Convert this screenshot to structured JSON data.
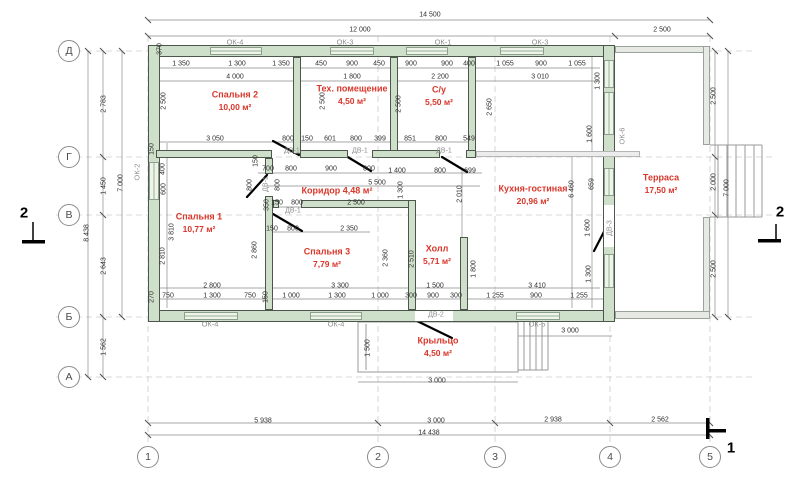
{
  "drawing": {
    "type": "floor-plan",
    "colors": {
      "wall": "#cfe0ca",
      "accent_red": "#d8372b",
      "gray_label": "#8e8e8e",
      "dim_text": "#2e2e2e"
    },
    "rooms": [
      {
        "name": "Спальня 2",
        "area": "10,00 м²",
        "x": 235,
        "y": 95
      },
      {
        "name": "Тех. помещение",
        "area": "4,50 м²",
        "x": 352,
        "y": 89
      },
      {
        "name": "С/у",
        "area": "5,50 м²",
        "x": 439,
        "y": 90
      },
      {
        "name": "Кухня-гостиная",
        "area": "20,96 м²",
        "x": 533,
        "y": 189
      },
      {
        "name": "Терраса",
        "area": "17,50 м²",
        "x": 661,
        "y": 178
      },
      {
        "name": "Коридор 4,48 м²",
        "area": "",
        "x": 337,
        "y": 191
      },
      {
        "name": "Спальня 1",
        "area": "10,77 м²",
        "x": 199,
        "y": 217
      },
      {
        "name": "Спальня 3",
        "area": "7,79 м²",
        "x": 327,
        "y": 252
      },
      {
        "name": "Холл",
        "area": "5,71 м²",
        "x": 437,
        "y": 249
      },
      {
        "name": "Крыльцо",
        "area": "4,50 м²",
        "x": 438,
        "y": 341
      }
    ],
    "window_labels": [
      {
        "t": "ОК-4",
        "x": 235,
        "y": 42
      },
      {
        "t": "ОК-3",
        "x": 345,
        "y": 42
      },
      {
        "t": "ОК-1",
        "x": 443,
        "y": 42
      },
      {
        "t": "ОК-3",
        "x": 540,
        "y": 42
      },
      {
        "t": "ОК-2",
        "x": 137,
        "y": 172,
        "r": 1
      },
      {
        "t": "ОК-6",
        "x": 622,
        "y": 136,
        "r": 1
      },
      {
        "t": "ОК-4",
        "x": 210,
        "y": 324
      },
      {
        "t": "ОК-4",
        "x": 336,
        "y": 324
      },
      {
        "t": "ОК-5",
        "x": 537,
        "y": 324
      }
    ],
    "door_labels": [
      {
        "t": "ДВ-1",
        "x": 292,
        "y": 151
      },
      {
        "t": "ДВ-1",
        "x": 360,
        "y": 151
      },
      {
        "t": "ДВ-1",
        "x": 444,
        "y": 151
      },
      {
        "t": "ДВ-1",
        "x": 266,
        "y": 184,
        "r": 1
      },
      {
        "t": "ДВ-1",
        "x": 293,
        "y": 211
      },
      {
        "t": "ДВ-2",
        "x": 436,
        "y": 315
      },
      {
        "t": "ДВ-3",
        "x": 610,
        "y": 228,
        "r": 1
      }
    ],
    "dims": [
      {
        "t": "14 500",
        "x": 430,
        "y": 15
      },
      {
        "t": "12 000",
        "x": 360,
        "y": 30
      },
      {
        "t": "2 500",
        "x": 662,
        "y": 30
      },
      {
        "t": "1 350",
        "x": 181,
        "y": 64
      },
      {
        "t": "1 300",
        "x": 237,
        "y": 64
      },
      {
        "t": "1 350",
        "x": 281,
        "y": 64
      },
      {
        "t": "450",
        "x": 321,
        "y": 64
      },
      {
        "t": "900",
        "x": 352,
        "y": 64
      },
      {
        "t": "450",
        "x": 379,
        "y": 64
      },
      {
        "t": "900",
        "x": 411,
        "y": 64
      },
      {
        "t": "900",
        "x": 447,
        "y": 64
      },
      {
        "t": "400",
        "x": 469,
        "y": 64
      },
      {
        "t": "1 055",
        "x": 505,
        "y": 64
      },
      {
        "t": "900",
        "x": 541,
        "y": 64
      },
      {
        "t": "1 055",
        "x": 577,
        "y": 64
      },
      {
        "t": "4 000",
        "x": 235,
        "y": 77
      },
      {
        "t": "1 800",
        "x": 352,
        "y": 77
      },
      {
        "t": "2 200",
        "x": 440,
        "y": 77
      },
      {
        "t": "3 010",
        "x": 540,
        "y": 77
      },
      {
        "t": "370",
        "x": 160,
        "y": 49,
        "r": 1
      },
      {
        "t": "2 500",
        "x": 164,
        "y": 101,
        "r": 1
      },
      {
        "t": "2 500",
        "x": 323,
        "y": 101,
        "r": 1
      },
      {
        "t": "2 500",
        "x": 399,
        "y": 104,
        "r": 1
      },
      {
        "t": "2 650",
        "x": 490,
        "y": 107,
        "r": 1
      },
      {
        "t": "1 300",
        "x": 598,
        "y": 81,
        "r": 1
      },
      {
        "t": "3 050",
        "x": 215,
        "y": 139
      },
      {
        "t": "800",
        "x": 288,
        "y": 139
      },
      {
        "t": "150",
        "x": 307,
        "y": 139
      },
      {
        "t": "601",
        "x": 330,
        "y": 139
      },
      {
        "t": "800",
        "x": 356,
        "y": 139
      },
      {
        "t": "399",
        "x": 380,
        "y": 139
      },
      {
        "t": "851",
        "x": 410,
        "y": 139
      },
      {
        "t": "800",
        "x": 441,
        "y": 139
      },
      {
        "t": "549",
        "x": 469,
        "y": 139
      },
      {
        "t": "700",
        "x": 268,
        "y": 169
      },
      {
        "t": "800",
        "x": 291,
        "y": 169
      },
      {
        "t": "900",
        "x": 331,
        "y": 169
      },
      {
        "t": "800",
        "x": 369,
        "y": 169
      },
      {
        "t": "1 400",
        "x": 397,
        "y": 171
      },
      {
        "t": "800",
        "x": 440,
        "y": 171
      },
      {
        "t": "699",
        "x": 470,
        "y": 171
      },
      {
        "t": "5 500",
        "x": 377,
        "y": 183
      },
      {
        "t": "1 300",
        "x": 401,
        "y": 190,
        "r": 1
      },
      {
        "t": "2 010",
        "x": 460,
        "y": 194,
        "r": 1
      },
      {
        "t": "150",
        "x": 256,
        "y": 161,
        "r": 1
      },
      {
        "t": "800",
        "x": 250,
        "y": 185,
        "r": 1
      },
      {
        "t": "800",
        "x": 278,
        "y": 185,
        "r": 1
      },
      {
        "t": "350",
        "x": 267,
        "y": 205,
        "r": 1
      },
      {
        "t": "150",
        "x": 277,
        "y": 203
      },
      {
        "t": "800",
        "x": 297,
        "y": 203
      },
      {
        "t": "2 500",
        "x": 356,
        "y": 203
      },
      {
        "t": "150",
        "x": 272,
        "y": 229
      },
      {
        "t": "800",
        "x": 293,
        "y": 229
      },
      {
        "t": "2 350",
        "x": 349,
        "y": 229
      },
      {
        "t": "150",
        "x": 152,
        "y": 149,
        "r": 1
      },
      {
        "t": "400",
        "x": 163,
        "y": 169,
        "r": 1
      },
      {
        "t": "600",
        "x": 164,
        "y": 189,
        "r": 1
      },
      {
        "t": "3 810",
        "x": 172,
        "y": 232,
        "r": 1
      },
      {
        "t": "2 810",
        "x": 163,
        "y": 256,
        "r": 1
      },
      {
        "t": "2 860",
        "x": 255,
        "y": 250,
        "r": 1
      },
      {
        "t": "2 360",
        "x": 386,
        "y": 258,
        "r": 1
      },
      {
        "t": "2 510",
        "x": 412,
        "y": 259,
        "r": 1
      },
      {
        "t": "1 800",
        "x": 474,
        "y": 269,
        "r": 1
      },
      {
        "t": "6 460",
        "x": 572,
        "y": 189,
        "r": 1
      },
      {
        "t": "1 600",
        "x": 590,
        "y": 134,
        "r": 1
      },
      {
        "t": "659",
        "x": 592,
        "y": 184,
        "r": 1
      },
      {
        "t": "1 600",
        "x": 588,
        "y": 228,
        "r": 1
      },
      {
        "t": "1 300",
        "x": 589,
        "y": 274,
        "r": 1
      },
      {
        "t": "2 783",
        "x": 104,
        "y": 104,
        "r": 1
      },
      {
        "t": "1 450",
        "x": 104,
        "y": 186,
        "r": 1
      },
      {
        "t": "7 000",
        "x": 121,
        "y": 183,
        "r": 1
      },
      {
        "t": "8 438",
        "x": 87,
        "y": 233,
        "r": 1
      },
      {
        "t": "2 643",
        "x": 104,
        "y": 266,
        "r": 1
      },
      {
        "t": "1 562",
        "x": 104,
        "y": 347,
        "r": 1
      },
      {
        "t": "2 500",
        "x": 714,
        "y": 96,
        "r": 1
      },
      {
        "t": "2 000",
        "x": 714,
        "y": 182,
        "r": 1
      },
      {
        "t": "2 500",
        "x": 714,
        "y": 269,
        "r": 1
      },
      {
        "t": "7 000",
        "x": 727,
        "y": 188,
        "r": 1
      },
      {
        "t": "2 800",
        "x": 212,
        "y": 286
      },
      {
        "t": "3 300",
        "x": 340,
        "y": 286
      },
      {
        "t": "1 500",
        "x": 435,
        "y": 286
      },
      {
        "t": "3 410",
        "x": 537,
        "y": 286
      },
      {
        "t": "270",
        "x": 152,
        "y": 297,
        "r": 1
      },
      {
        "t": "750",
        "x": 168,
        "y": 296
      },
      {
        "t": "1 300",
        "x": 212,
        "y": 296
      },
      {
        "t": "750",
        "x": 250,
        "y": 296
      },
      {
        "t": "150",
        "x": 266,
        "y": 297,
        "r": 1
      },
      {
        "t": "1 000",
        "x": 291,
        "y": 296
      },
      {
        "t": "1 300",
        "x": 337,
        "y": 296
      },
      {
        "t": "1 000",
        "x": 380,
        "y": 296
      },
      {
        "t": "300",
        "x": 411,
        "y": 296
      },
      {
        "t": "900",
        "x": 433,
        "y": 296
      },
      {
        "t": "300",
        "x": 456,
        "y": 296
      },
      {
        "t": "1 255",
        "x": 495,
        "y": 296
      },
      {
        "t": "900",
        "x": 536,
        "y": 296
      },
      {
        "t": "1 255",
        "x": 579,
        "y": 296
      },
      {
        "t": "1 500",
        "x": 368,
        "y": 348,
        "r": 1
      },
      {
        "t": "3 000",
        "x": 437,
        "y": 381
      },
      {
        "t": "3 000",
        "x": 570,
        "y": 331
      },
      {
        "t": "5 938",
        "x": 263,
        "y": 421
      },
      {
        "t": "3 000",
        "x": 436,
        "y": 421
      },
      {
        "t": "2 938",
        "x": 553,
        "y": 420
      },
      {
        "t": "2 562",
        "x": 660,
        "y": 420
      },
      {
        "t": "14 438",
        "x": 429,
        "y": 433
      }
    ],
    "axes_left": [
      {
        "t": "Д",
        "x": 69,
        "y": 51
      },
      {
        "t": "Г",
        "x": 69,
        "y": 157
      },
      {
        "t": "В",
        "x": 69,
        "y": 215
      },
      {
        "t": "Б",
        "x": 69,
        "y": 317
      },
      {
        "t": "А",
        "x": 69,
        "y": 377
      }
    ],
    "axes_bottom": [
      {
        "t": "1",
        "x": 148,
        "y": 457
      },
      {
        "t": "2",
        "x": 378,
        "y": 457
      },
      {
        "t": "3",
        "x": 495,
        "y": 457
      },
      {
        "t": "4",
        "x": 610,
        "y": 457
      },
      {
        "t": "5",
        "x": 710,
        "y": 457
      }
    ],
    "section_marks": [
      {
        "t": "2",
        "x": 24,
        "y": 213
      },
      {
        "t": "2",
        "x": 780,
        "y": 212
      },
      {
        "t": "1",
        "x": 731,
        "y": 448
      }
    ]
  }
}
